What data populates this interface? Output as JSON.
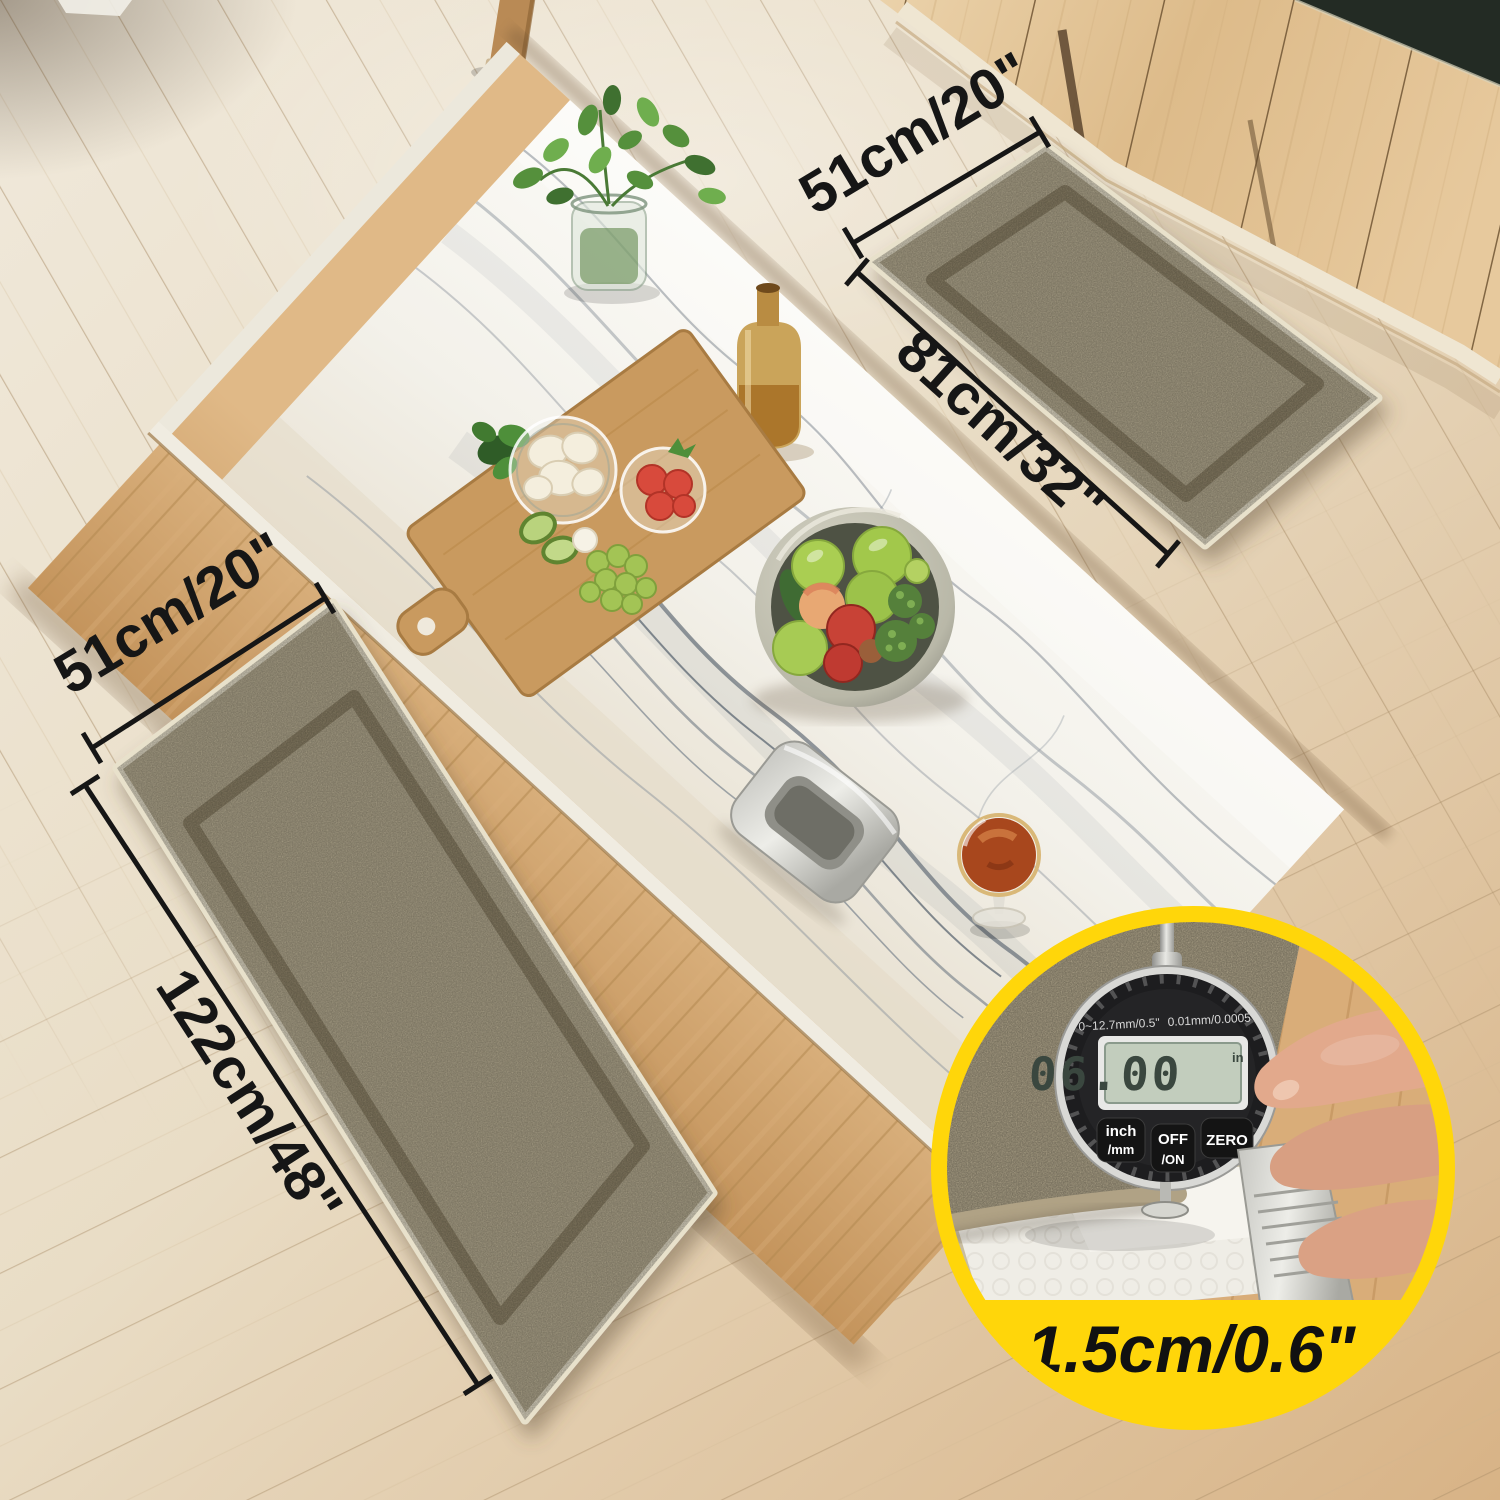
{
  "meta": {
    "description": "Product photo of a beige two-piece non-slip kitchen mat set shown in a kitchen with a marble island, light wood floor and wood cabinets, with size annotations and a thickness-measurement inset",
    "scene": "kitchen overhead view"
  },
  "colors": {
    "accent_yellow": "#ffd60a",
    "annotation_black": "#161616",
    "mat_beige": "#b6ac91",
    "mat_groove": "#8c8166",
    "floor_light": "#efe8da",
    "floor_warm": "#d9b98c",
    "marble_white": "#f6f4ee",
    "cabinet_wood": "#e4c79c",
    "counter_dark_green": "#232b24"
  },
  "dimension_labels": {
    "small_mat_width": "51cm/20\"",
    "small_mat_length": "81cm/32\"",
    "runner_width": "51cm/20\"",
    "runner_length": "122cm/48\""
  },
  "thickness_inset": {
    "label": "1.5cm/0.6\"",
    "gauge": {
      "spec_left": "0~12.7mm/0.5\"",
      "spec_right": "0.01mm/0.0005\"",
      "display_value": "06.00",
      "display_unit": "in",
      "buttons": [
        {
          "top": "inch",
          "bottom": "/mm"
        },
        {
          "top": "OFF",
          "bottom": "/ON"
        },
        {
          "top": "ZERO",
          "bottom": ""
        }
      ]
    }
  }
}
